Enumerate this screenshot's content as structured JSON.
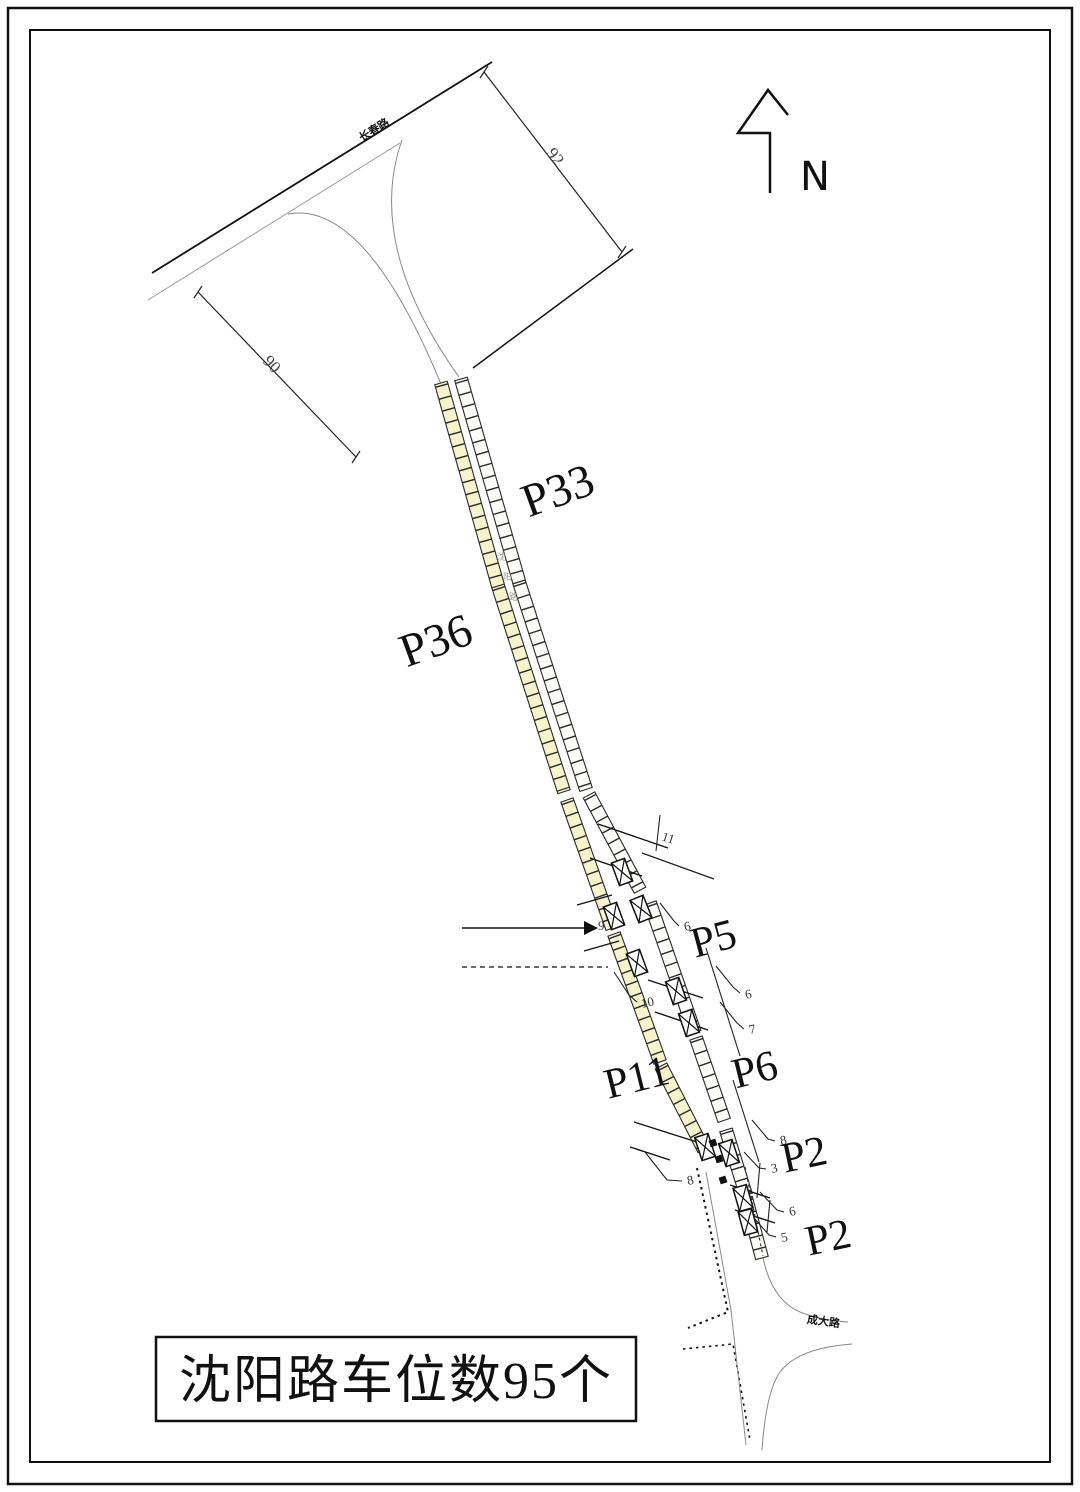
{
  "title_block": {
    "text": "沈阳路车位数95个"
  },
  "north_arrow": {
    "label": "N"
  },
  "roads": {
    "top_label": "长春路",
    "main_label_chars": [
      "沈",
      "阳",
      "路"
    ],
    "bottom_label": "成大路"
  },
  "parking_labels": {
    "p33": "P33",
    "p36": "P36",
    "p5": "P5",
    "p6": "P6",
    "p11": "P11",
    "p2_upper": "P2",
    "p2_lower": "P2"
  },
  "dimensions": {
    "d92": "92",
    "d90": "90",
    "d11": "11",
    "d9": "9",
    "d6_top": "6",
    "d10": "10",
    "d6_mid": "6",
    "d7": "7",
    "d8_right": "8",
    "d3": "3",
    "d8_left": "8",
    "d6_low": "6",
    "d5": "5"
  },
  "colors": {
    "parking_yellow": "#f7f3cd",
    "parking_white": "#fdfdfa"
  }
}
